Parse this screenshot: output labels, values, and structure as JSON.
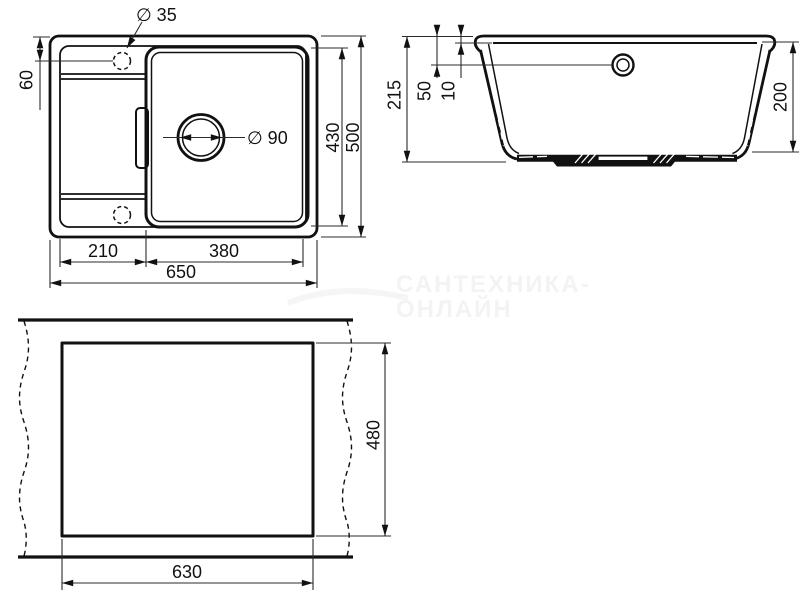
{
  "drawing": {
    "type": "sink-technical-drawing",
    "plan": {
      "faucet_hole": "∅ 35",
      "faucet_offset": "60",
      "drain_hole": "∅ 90",
      "bowl_length": "430",
      "overall_depth": "500",
      "drainboard_width": "210",
      "bowl_width": "380",
      "overall_width": "650"
    },
    "section": {
      "overall_height": "215",
      "overflow_offset": "50",
      "rim_height": "10",
      "bowl_depth": "200"
    },
    "cutout": {
      "cut_height": "480",
      "cut_width": "630"
    },
    "watermark": {
      "line1": "САНТЕХНИКА-",
      "line2": "ОНЛАЙН"
    },
    "colors": {
      "outline": "#111111",
      "dimension": "#2b2b2b",
      "background": "#ffffff",
      "watermark": "#f3f3f3"
    }
  }
}
